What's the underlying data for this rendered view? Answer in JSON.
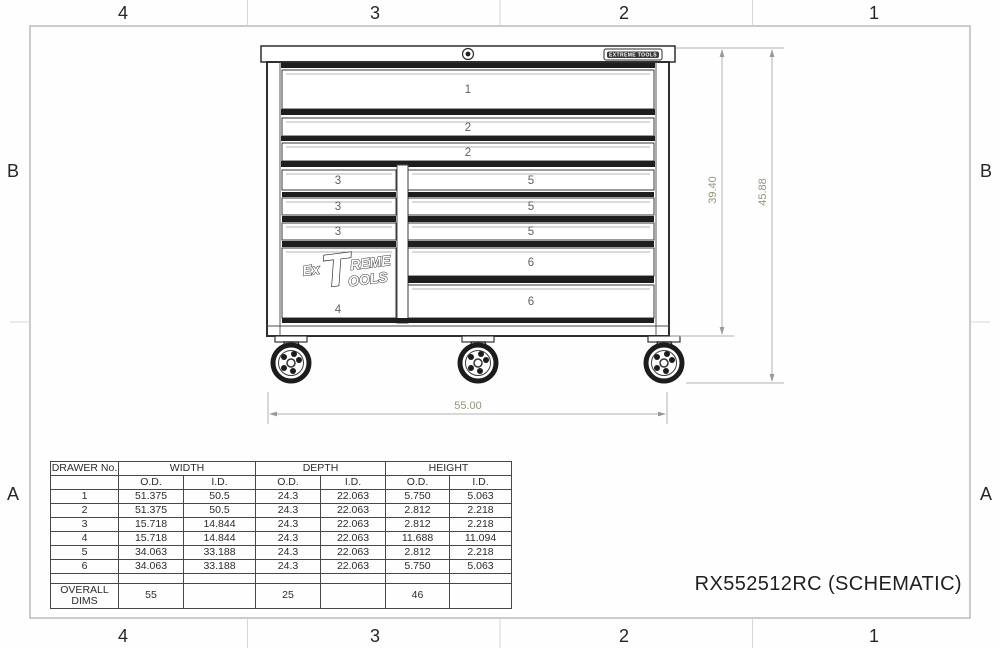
{
  "sheet": {
    "title": "RX552512RC (SCHEMATIC)",
    "zones_top": [
      "4",
      "3",
      "2",
      "1"
    ],
    "zones_bottom": [
      "4",
      "3",
      "2",
      "1"
    ],
    "zones_left": [
      "B",
      "A"
    ],
    "zones_right": [
      "B",
      "A"
    ]
  },
  "cabinet": {
    "badge_text": "EXTREME TOOLS",
    "logo": {
      "ex": "Ex",
      "t": "T",
      "reme": "REME",
      "ools": "OOLS"
    },
    "drawer_numbers": {
      "d1": "1",
      "d2": "2",
      "d3": "3",
      "d4": "4",
      "d5": "5",
      "d6": "6"
    },
    "dims": {
      "body_height": "39.40",
      "overall_height": "45.88",
      "overall_width": "55.00"
    }
  },
  "table": {
    "headers": {
      "drawer_no": "DRAWER No.",
      "width": "WIDTH",
      "depth": "DEPTH",
      "height": "HEIGHT",
      "od": "O.D.",
      "id": "I.D."
    },
    "rows": [
      [
        "1",
        "51.375",
        "50.5",
        "24.3",
        "22.063",
        "5.750",
        "5.063"
      ],
      [
        "2",
        "51.375",
        "50.5",
        "24.3",
        "22.063",
        "2.812",
        "2.218"
      ],
      [
        "3",
        "15.718",
        "14.844",
        "24.3",
        "22.063",
        "2.812",
        "2.218"
      ],
      [
        "4",
        "15.718",
        "14.844",
        "24.3",
        "22.063",
        "11.688",
        "11.094"
      ],
      [
        "5",
        "34.063",
        "33.188",
        "24.3",
        "22.063",
        "2.812",
        "2.218"
      ],
      [
        "6",
        "34.063",
        "33.188",
        "24.3",
        "22.063",
        "5.750",
        "5.063"
      ]
    ],
    "overall": {
      "label": "OVERALL DIMS",
      "width_od": "55",
      "depth_od": "25",
      "height_od": "46"
    }
  }
}
